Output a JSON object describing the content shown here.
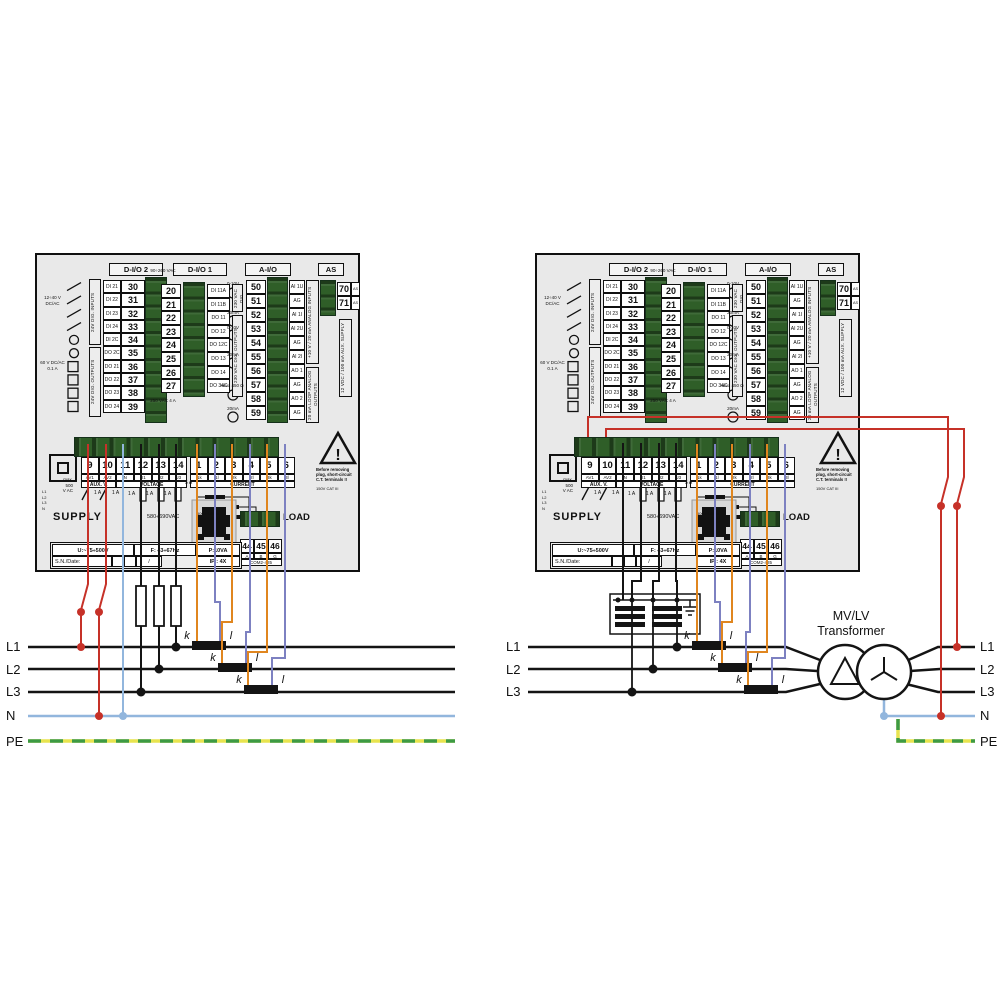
{
  "device": {
    "blocks": {
      "dio2": {
        "title": "D-I/O 2",
        "left_note_top": "12÷40 V DC/AC",
        "left_note_bottom": "60 V DC/AC 0.1 A",
        "vtext_top": "24V DIG. INPUTS",
        "vtext_bottom": "24V DIG. OUTPUTS",
        "rows": [
          {
            "label": "DI 21",
            "num": "30"
          },
          {
            "label": "DI 22",
            "num": "31"
          },
          {
            "label": "DI 23",
            "num": "32"
          },
          {
            "label": "DI 24",
            "num": "33"
          },
          {
            "label": "DI 2C",
            "num": "34"
          },
          {
            "label": "DO 2C",
            "num": "35"
          },
          {
            "label": "DO 21",
            "num": "36"
          },
          {
            "label": "DO 22",
            "num": "37"
          },
          {
            "label": "DO 23",
            "num": "38"
          },
          {
            "label": "DO 24",
            "num": "39"
          }
        ]
      },
      "dio1": {
        "title": "D-I/O 1",
        "note_top": "90÷260 VAC",
        "note_bottom": "250 VAC 4 A",
        "vtext_top": "230 VAC DIG. INPUTS",
        "vtext_bottom": "230 VAC DIG. OUTPUTS",
        "rows": [
          {
            "num": "20",
            "label": "DI 11A"
          },
          {
            "num": "21",
            "label": "DI 11B"
          },
          {
            "num": "22",
            "label": "DO 11"
          },
          {
            "num": "23",
            "label": "DO 12"
          },
          {
            "num": "24",
            "label": "DO 12C"
          },
          {
            "num": "25",
            "label": "DO 13"
          },
          {
            "num": "26",
            "label": "DO 14"
          },
          {
            "num": "27",
            "label": "DO 34C"
          }
        ]
      },
      "aio": {
        "title": "A-I/O",
        "notes": [
          "0-10V",
          "20mA",
          "0-10V",
          "20mA",
          "max. 450 Ω",
          "20mA"
        ],
        "vtext_top": "+10 V / 20 mA ANALOG INPUTS",
        "vtext_bottom": "20 mA LOOP ANALOG OUTPUTS",
        "rows": [
          {
            "num": "50",
            "label": "AI 1U"
          },
          {
            "num": "51",
            "label": "AG"
          },
          {
            "num": "52",
            "label": "AI 1I"
          },
          {
            "num": "53",
            "label": "AI 2U"
          },
          {
            "num": "54",
            "label": "AG"
          },
          {
            "num": "55",
            "label": "AI 2I"
          },
          {
            "num": "56",
            "label": "AO 1"
          },
          {
            "num": "57",
            "label": "AG"
          },
          {
            "num": "58",
            "label": "AO 2"
          },
          {
            "num": "59",
            "label": "AG"
          }
        ]
      },
      "as": {
        "title": "AS",
        "vtext": "12 VDC / 100 mA AUX. SUPPLY",
        "rows": [
          {
            "num": "70",
            "label": "AS +"
          },
          {
            "num": "71",
            "label": "AS −"
          }
        ]
      }
    },
    "bottom": {
      "aux_terms": [
        {
          "num": "9",
          "sub": "AV1"
        },
        {
          "num": "10",
          "sub": "AV2"
        },
        {
          "num": "11",
          "sub": "N"
        },
        {
          "num": "12",
          "sub": "U1"
        },
        {
          "num": "13",
          "sub": "U2"
        },
        {
          "num": "14",
          "sub": "U3"
        }
      ],
      "cur_terms": [
        {
          "num": "1",
          "sub": "I1k"
        },
        {
          "num": "2",
          "sub": "I1l"
        },
        {
          "num": "3",
          "sub": "I2k"
        },
        {
          "num": "4",
          "sub": "I2l"
        },
        {
          "num": "5",
          "sub": "I3k"
        },
        {
          "num": "6",
          "sub": "I3l"
        }
      ],
      "group_aux": "AUX. V.",
      "group_volt": "VOLTAGE",
      "group_cur": "CURRENT",
      "max_vac_1": "max.",
      "max_vac_2": "500",
      "max_vac_3": "V AC",
      "fuse_label": "1 A",
      "fuse5": "5 A",
      "phase_mini": [
        "L1",
        "L2",
        "L3",
        "N"
      ],
      "supply": "SUPPLY",
      "supply_range": "580÷690VAC",
      "cat1": "500V CAT III",
      "cat2": "300V CAT IV",
      "warning_1": "Before removing",
      "warning_2": "plug, short-circuit",
      "warning_3": "C.T. terminals !!",
      "warn_cat": "150V CAT III",
      "load": "LOAD",
      "com_terms": [
        "44",
        "45",
        "46"
      ],
      "com_subs": [
        "A",
        "B",
        "G"
      ],
      "com_name": "COM2-485",
      "info": {
        "u": "U:~75÷500V",
        "f": "F: 43÷67Hz",
        "p": "P:10VA",
        "sn": "S.N./Date:",
        "sep": "/",
        "ip": "IP : 4X"
      }
    }
  },
  "wiring": {
    "k": "k",
    "l": "l",
    "left_labels": [
      "L1",
      "L2",
      "L3",
      "N",
      "PE"
    ],
    "right_mid_labels": [
      "L1",
      "L2",
      "L3"
    ],
    "right_labels": [
      "L1",
      "L2",
      "L3",
      "N",
      "PE"
    ],
    "transformer_1": "MV/LV",
    "transformer_2": "Transformer",
    "colors": {
      "phase_black": "#141414",
      "aux_red": "#c63128",
      "neutral_blue": "#92b6dd",
      "ct_orange": "#e0861f",
      "ct_violet": "#7d81c1",
      "pe_yellow": "#e8e44f",
      "pe_green": "#3d9a44",
      "connector_green": "#2f5e28"
    }
  }
}
